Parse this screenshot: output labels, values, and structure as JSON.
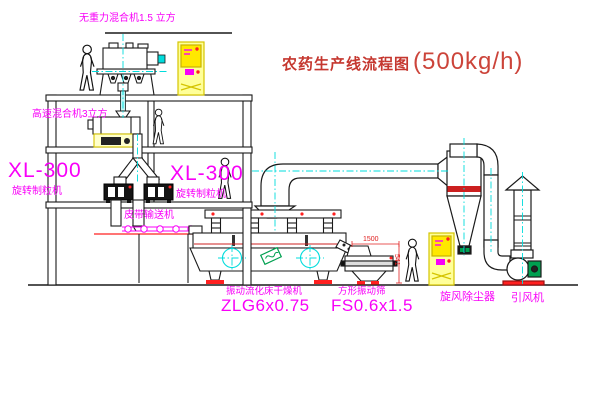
{
  "title": {
    "text_cn": "农药生产线流程图",
    "capacity": "(500kg/h)"
  },
  "equipment_labels": {
    "gravity_free_mixer": "无重力混合机1.5 立方",
    "high_speed_mixer": "高速混合机3立方",
    "granulator_left": {
      "model": "XL-300",
      "name": "旋转制粒机"
    },
    "granulator_right": {
      "model": "XL-300",
      "name": "旋转制粒机"
    },
    "belt_conveyor": "皮带输送机",
    "fluid_bed_dryer": {
      "name": "振动流化床干燥机",
      "model": "ZLG6x0.75"
    },
    "square_sieve": {
      "name": "方形振动筛",
      "model": "FS0.6x1.5"
    },
    "cyclone": "旋风除尘器",
    "induced_draft_fan": "引风机"
  },
  "dimensions": {
    "sieve_width": "1500",
    "sieve_height": "541"
  },
  "colors": {
    "label_magenta": "#f800f8",
    "title_red": "#c5372f",
    "centerline_cyan": "#00dcdc",
    "cabinet_yellow": "#ffe800",
    "accent_red": "#ff2020",
    "motor_green": "#00a050"
  }
}
